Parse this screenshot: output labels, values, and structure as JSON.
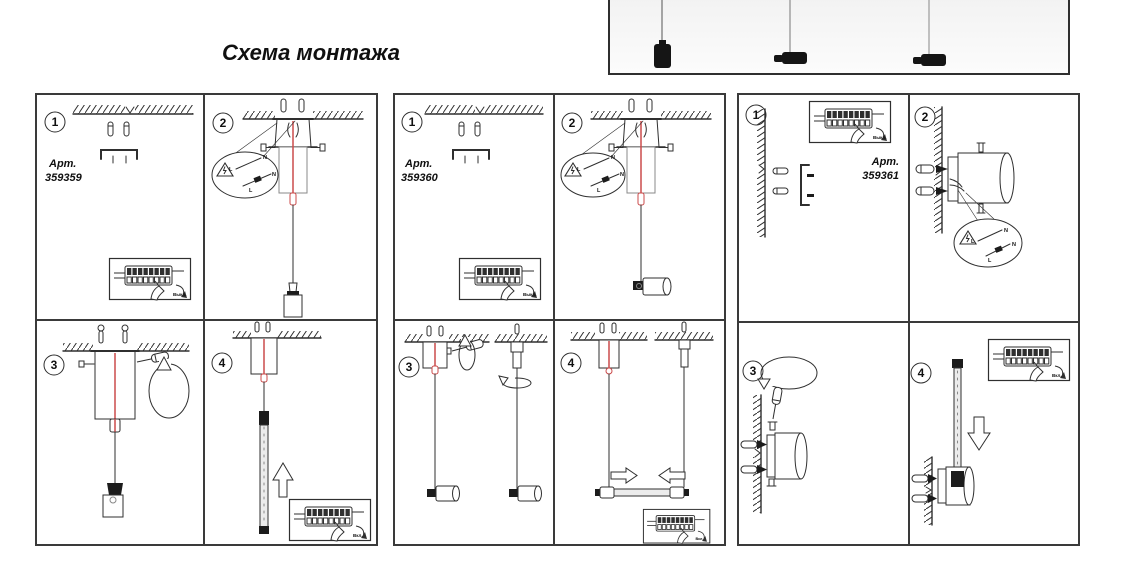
{
  "title": "Схема монтажа",
  "labels": {
    "art": "Арт.",
    "switch_off": "Выкл.",
    "switch_on": "Вкл.",
    "wire_n": "N",
    "wire_l": "L"
  },
  "panels": [
    {
      "art_number": "359359",
      "steps": [
        "1",
        "2",
        "3",
        "4"
      ]
    },
    {
      "art_number": "359360",
      "steps": [
        "1",
        "2",
        "3",
        "4"
      ]
    },
    {
      "art_number": "359361",
      "steps": [
        "1",
        "2",
        "3",
        "4"
      ]
    }
  ],
  "icons": {
    "warning_triangle": "high-voltage-warning",
    "terminal_block_inset": "breaker-switch-off-on",
    "screwdriver": "screwdriver",
    "rotate_arrow": "rotate",
    "up_arrow": "insert-upward",
    "down_arrow": "insert-downward",
    "ceiling_hatch": "ceiling",
    "wall_hatch": "wall"
  }
}
